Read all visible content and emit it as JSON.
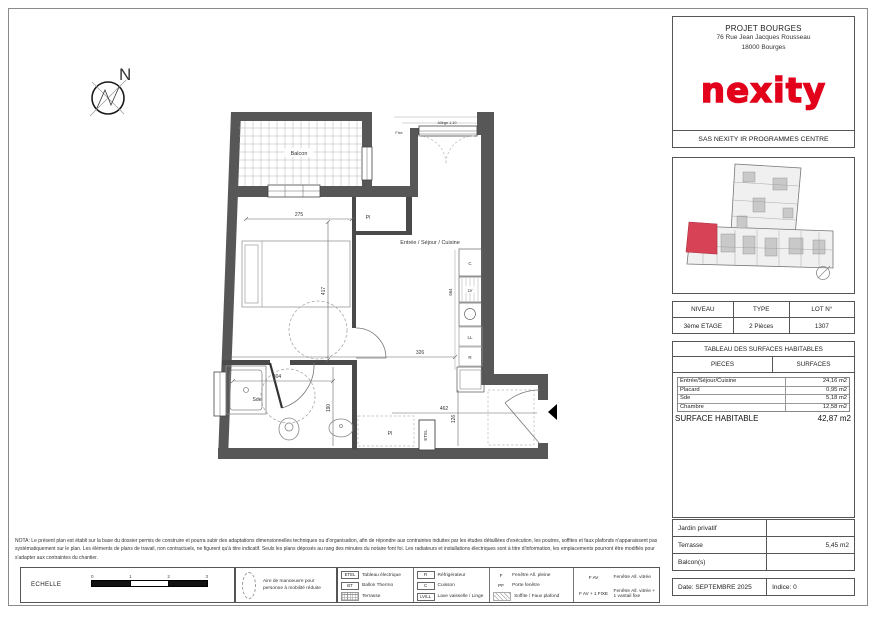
{
  "colors": {
    "accent": "#e2001a",
    "unit_highlight": "#d84256",
    "wall": "#575757"
  },
  "header": {
    "project": "PROJET BOURGES",
    "address1": "76 Rue Jean Jacques Rousseau",
    "address2": "18000 Bourges",
    "logo": "nexity",
    "company": "SAS NEXITY IR PROGRAMMES CENTRE"
  },
  "lot": {
    "h_niveau": "NIVEAU",
    "h_type": "TYPE",
    "h_lot": "LOT N°",
    "niveau": "3ème ETAGE",
    "type": "2 Pièces",
    "lot": "1307"
  },
  "surfaces": {
    "title": "TABLEAU DES SURFACES HABITABLES",
    "col1": "PIECES",
    "col2": "SURFACES",
    "rows": [
      {
        "label": "Entrée/Séjour/Cuisine",
        "value": "24,16 m2"
      },
      {
        "label": "Placard",
        "value": "0,95 m2"
      },
      {
        "label": "Sde",
        "value": "5,18 m2"
      },
      {
        "label": "Chambre",
        "value": "12,58 m2"
      }
    ],
    "total_label": "SURFACE HABITABLE",
    "total_value": "42,87 m2"
  },
  "annex": {
    "jardin_label": "Jardin privatif",
    "jardin_value": "",
    "terrasse_label": "Terrasse",
    "terrasse_value": "5,45 m2",
    "balcon_label": "Balcon(s)",
    "balcon_value": ""
  },
  "footer": {
    "date": "Date: SEPTEMBRE 2025",
    "indice": "Indice: 0"
  },
  "nota": "NOTA: Le présent plan est établi sur la base du dossier permis de construire et pourra subir des adaptations dimensionnelles techniques ou d'organisation, afin de répondre aux contraintes induites par les études détaillées d'exécution, les poutres, soffites et faux plafonds n'apparaissent pas systématiquement sur le plan. Les éléments de plans de travail, non contractuels, ne figurent qu'à titre indicatif. Seuls les plans déposés au rang des minutes du notaire font foi. Les radiateurs et installations électriques sont à titre d'information, les emplacements pourront être modifiés pour s'adapter aux contraintes du chantier.",
  "echelle": {
    "label": "ECHELLE",
    "t0": "0",
    "t1": "1",
    "t2": "2",
    "t3": "3"
  },
  "pmr": "Aire de manoeuvre pour personne à mobilité réduite",
  "legend": {
    "etel_key": "ETEL",
    "etel": "Tableau électrique",
    "bt_key": "BT",
    "bt": "Ballon Thermo",
    "terrasse": "Terrasse",
    "r_key": "R",
    "r": "Réfrigérateur",
    "c_key": "C",
    "c": "Cuisson",
    "lvll_key": "LV/LL",
    "lvll": "Lave vaisselle / Linge",
    "f_key": "F",
    "f": "Fenêtre All. pleine",
    "pf_key": "PF",
    "pf": "Porte fenêtre",
    "soffite": "Soffite / Faux plafond",
    "fav_key": "F AV",
    "fav": "Fenêtre All. vitrée",
    "favfixe_key": "F AV + 1 FIXE",
    "favfixe": "Fenêtre All. vitrée + 1 vantail fixe"
  },
  "plan": {
    "north": "N",
    "balcon": "Balcon",
    "chambre": "Chambre",
    "sejour": "Entrée / Séjour / Cuisine",
    "sde": "Sde",
    "pl": "Pl",
    "pl2": "Pl",
    "etel": "ETEL",
    "c": "C",
    "lv": "LV",
    "ll": "LL",
    "r": "R",
    "fixe": "Fixe",
    "allege": "Allège 1,10",
    "d275": "275",
    "d417": "417",
    "d326": "326",
    "d304": "304",
    "d190": "190",
    "d462": "462",
    "d126": "126",
    "d664": "664"
  }
}
